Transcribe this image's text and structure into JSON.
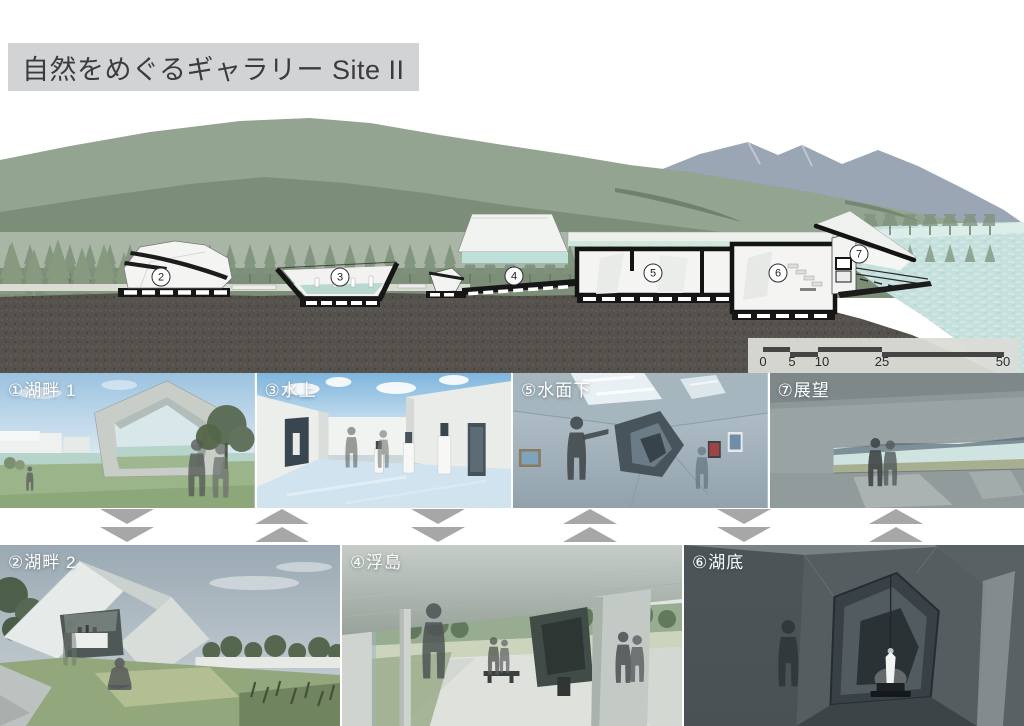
{
  "title": "自然をめぐるギャラリー Site II",
  "section": {
    "markers": [
      {
        "label": "2"
      },
      {
        "label": "3"
      },
      {
        "label": "4"
      },
      {
        "label": "5"
      },
      {
        "label": "6"
      },
      {
        "label": "7"
      }
    ],
    "scale": {
      "ticks": [
        "0",
        "5",
        "10",
        "25",
        "50"
      ]
    }
  },
  "galleries": {
    "top": [
      {
        "label": "①湖畔 1"
      },
      {
        "label": "③水上"
      },
      {
        "label": "⑤水面下"
      },
      {
        "label": "⑦展望"
      }
    ],
    "bottom": [
      {
        "label": "②湖畔 2"
      },
      {
        "label": "④浮島"
      },
      {
        "label": "⑥湖底"
      }
    ]
  },
  "arrows": [
    {
      "dir": "down"
    },
    {
      "dir": "up"
    },
    {
      "dir": "down"
    },
    {
      "dir": "up"
    },
    {
      "dir": "down"
    },
    {
      "dir": "up"
    }
  ],
  "colors": {
    "title_bg": "#d2d3d5",
    "arrow": "#a7a7a7",
    "ground": "#55514c",
    "mountain_green": "#93a490",
    "mountain_blue": "#9ba6b4",
    "lake": "#c6e0dd",
    "poche": "#161616"
  }
}
